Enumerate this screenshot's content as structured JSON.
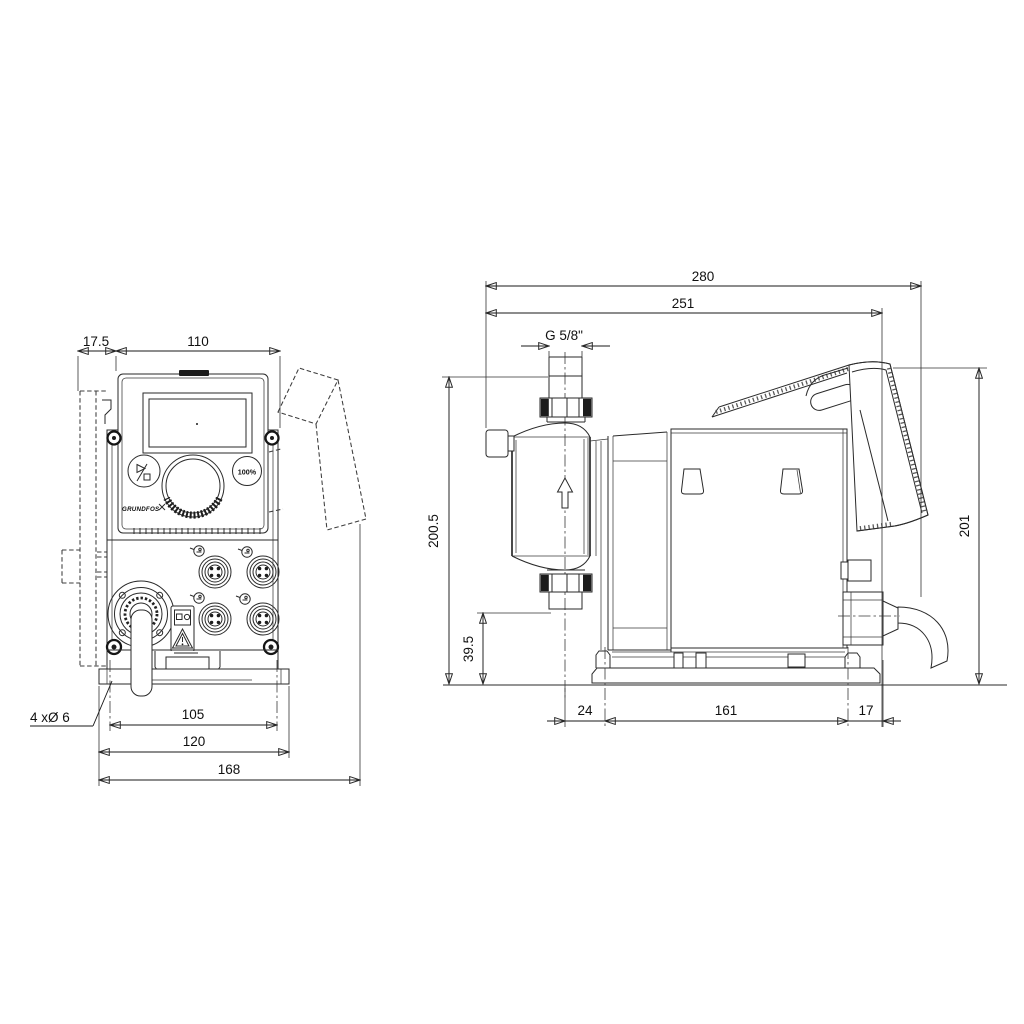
{
  "front_view": {
    "dims": {
      "bracket_offset": "17.5",
      "panel_width": "110",
      "hole_note": "4 xØ 6",
      "hole_spacing": "105",
      "plate_width": "120",
      "overall_width": "168"
    },
    "panel": {
      "capacity_button": "100%",
      "brand": "GRUNDFOS"
    }
  },
  "side_view": {
    "dims": {
      "overall_length": "280",
      "length_to_plate": "251",
      "connection_thread": "G 5/8\"",
      "connection_height": "200.5",
      "outlet_height": "39.5",
      "head_to_plate": "24",
      "plate_length": "161",
      "plate_to_rear": "17",
      "overall_height": "201"
    }
  }
}
